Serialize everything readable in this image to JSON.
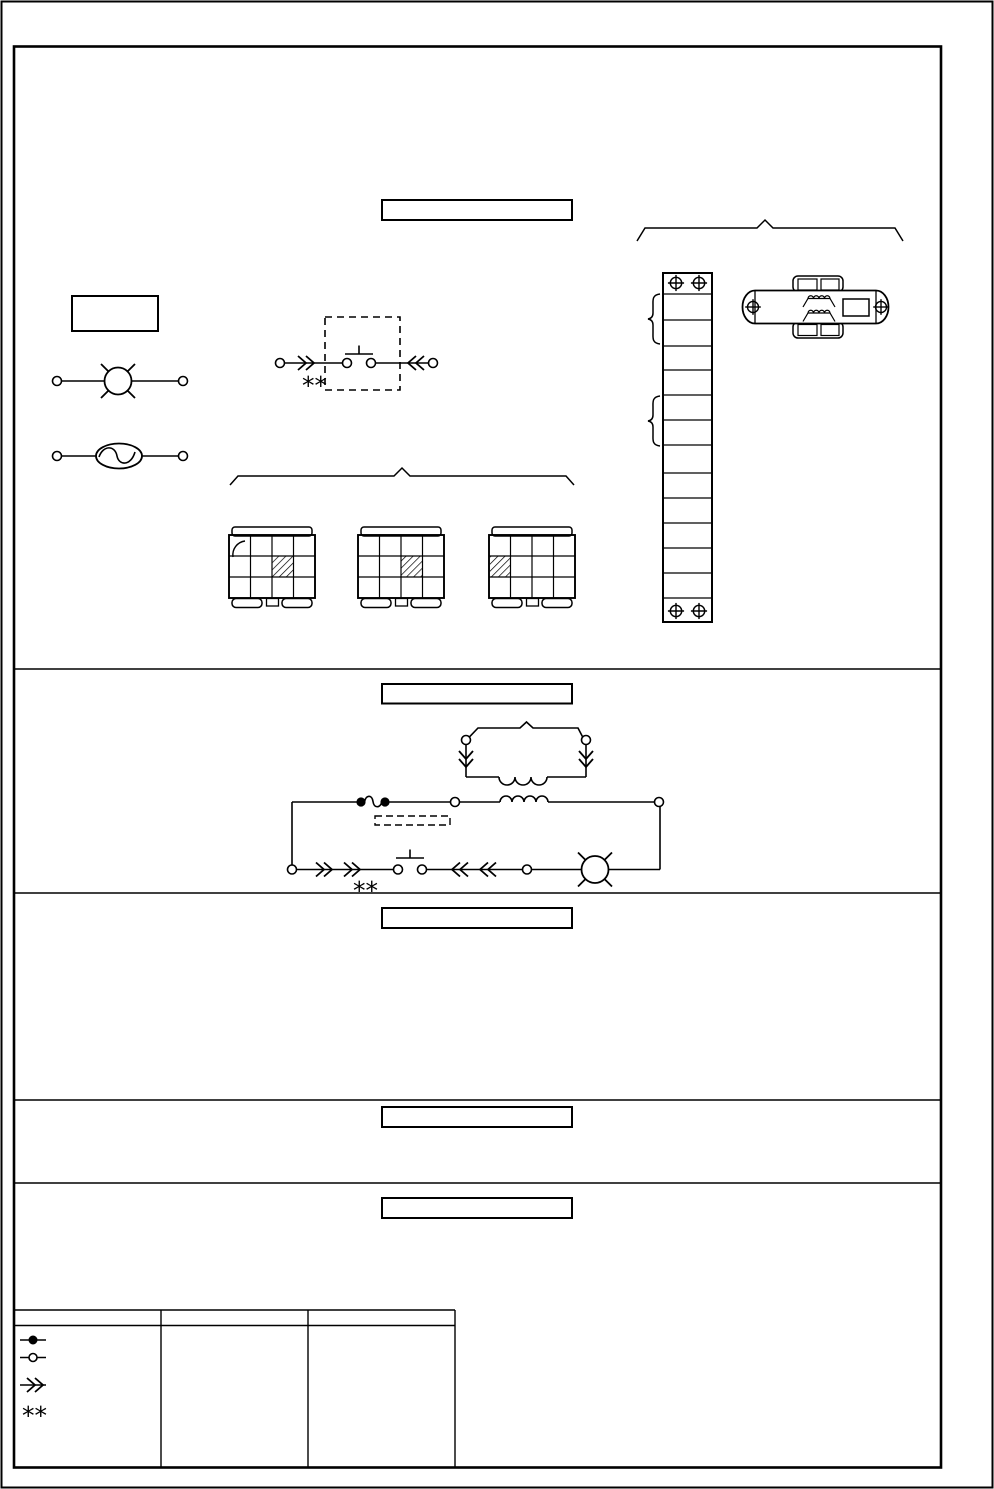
{
  "page": {
    "background": "#ffffff",
    "ink": "#000000"
  },
  "annotations": {
    "double_asterisk": "**"
  },
  "sections": [
    {
      "id": "parts-diagram",
      "title": "",
      "part_label": ""
    },
    {
      "id": "circuit-diagram",
      "title": ""
    },
    {
      "id": "section-three",
      "title": ""
    },
    {
      "id": "section-four",
      "title": ""
    },
    {
      "id": "section-five",
      "title": ""
    }
  ],
  "legend": {
    "headers": [
      "",
      "",
      ""
    ],
    "rows": [
      {
        "symbol": "filled-terminal-symbol",
        "label": ""
      },
      {
        "symbol": "open-terminal-symbol",
        "label": ""
      },
      {
        "symbol": "connector-chevron-symbol",
        "label": ""
      },
      {
        "symbol": "double-asterisk-symbol",
        "label": ""
      }
    ]
  }
}
